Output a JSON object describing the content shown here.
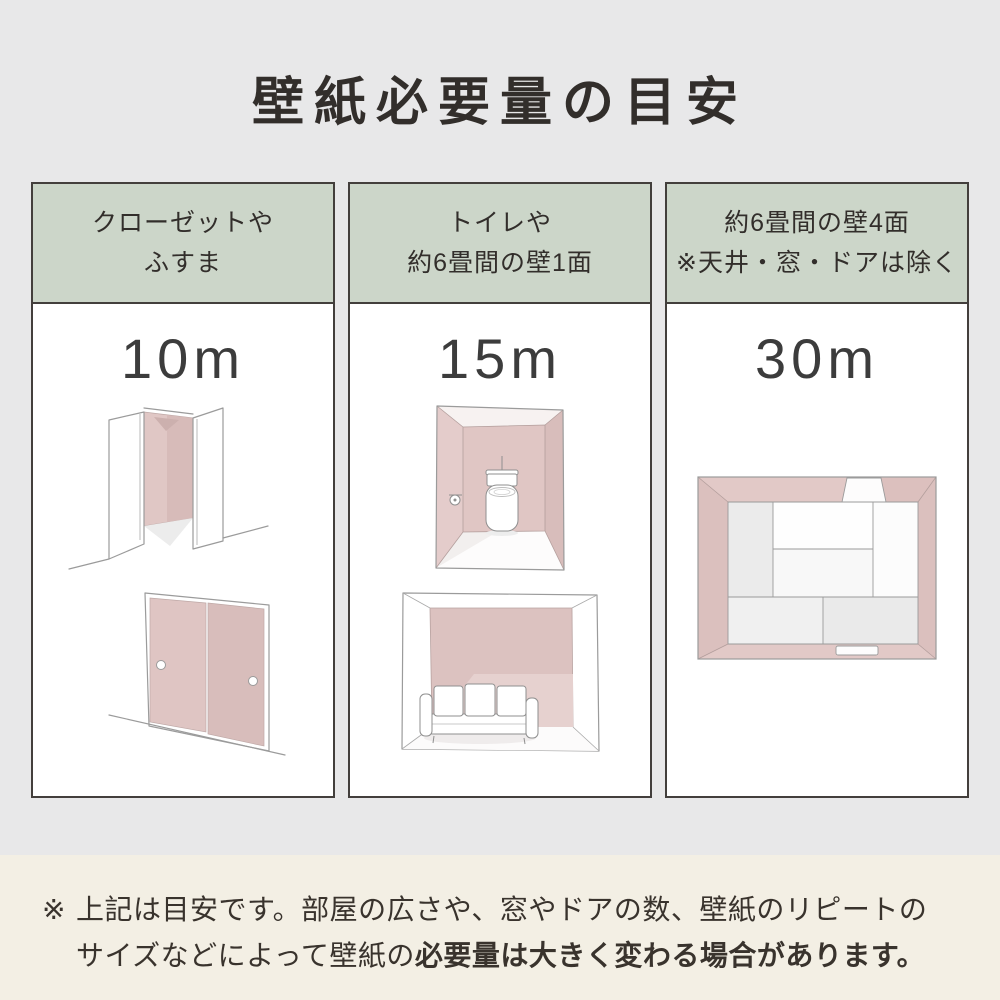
{
  "page": {
    "title": "壁紙必要量の目安"
  },
  "columns": [
    {
      "id": "closet-fusuma",
      "header_line1": "クローゼットや",
      "header_line2": "ふすま",
      "amount": "10m",
      "illustrations": [
        "closet-open-doors-illustration",
        "fusuma-sliding-doors-illustration"
      ]
    },
    {
      "id": "toilet-one-wall",
      "header_line1": "トイレや",
      "header_line2": "約6畳間の壁1面",
      "amount": "15m",
      "illustrations": [
        "toilet-room-illustration",
        "room-one-accent-wall-sofa-illustration"
      ]
    },
    {
      "id": "four-walls",
      "header_line1": "約6畳間の壁4面",
      "header_line2": "※天井・窓・ドアは除く",
      "amount": "30m",
      "illustrations": [
        "tatami-room-top-view-illustration"
      ]
    }
  ],
  "note": {
    "mark": "※",
    "line1": "上記は目安です。部屋の広さや、窓やドアの数、壁紙のリピートの",
    "line2_regular": "サイズなどによって壁紙の",
    "line2_bold": "必要量は大きく変わる場合があります。"
  },
  "colors": {
    "background_gray": "#e8e8e9",
    "header_green": "#ccd6c9",
    "note_beige": "#f3efe4",
    "wall_pink": "#e0c7c5",
    "wall_pink_dark": "#d8bdbb",
    "border_dark": "#433f3c",
    "text_dark": "#322e2b"
  }
}
